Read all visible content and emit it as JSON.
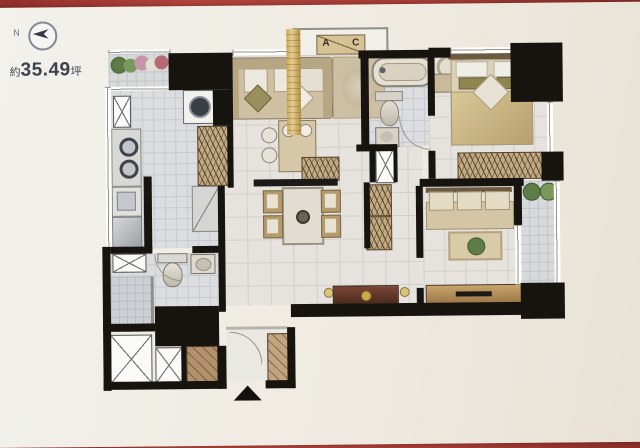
{
  "page": {
    "kind": "apartment floor plan brochure photo"
  },
  "compass": {
    "label": "N",
    "icon": "north-arrow-icon",
    "direction": "left"
  },
  "area": {
    "prefix": "約",
    "value": "35.49",
    "unit": "坪",
    "full_text": "約35.49坪"
  },
  "ac_platform": {
    "left": "A",
    "right": "C",
    "meaning": "air-conditioner outdoor unit platform"
  },
  "entry": {
    "marker": "up-arrow"
  },
  "colors": {
    "backdrop_red": "#a83d36",
    "paper": "#efebe2",
    "wall_black": "#17140f",
    "floor_tile": "#e6e3de",
    "wet_tile": "#dbdde0",
    "wood_tan": "#c2ab84",
    "gold_accent": "#caa85e",
    "console_brown": "#5a3326",
    "plant_green": "#5d7c46",
    "label_gray": "#3c414d"
  },
  "rooms": [
    "balcony-top-left",
    "kitchen",
    "bathroom-left",
    "entry-foyer",
    "living-dining",
    "main-bathroom",
    "master-bedroom",
    "bedroom-2",
    "balcony-right"
  ],
  "furniture": [
    "washing-machine",
    "stove",
    "kitchen-sink",
    "refrigerator",
    "pantry-cabinet",
    "toilet",
    "wash-basin",
    "shower",
    "sofa",
    "area-rug",
    "island-counter",
    "bar-stools",
    "tv-cabinet",
    "dining-table",
    "dining-chairs",
    "console-table",
    "bathtub",
    "double-bed",
    "nightstand",
    "table-lamp",
    "wardrobe",
    "single-bed",
    "rug-with-plant",
    "desk",
    "planters",
    "pipe-shafts"
  ]
}
